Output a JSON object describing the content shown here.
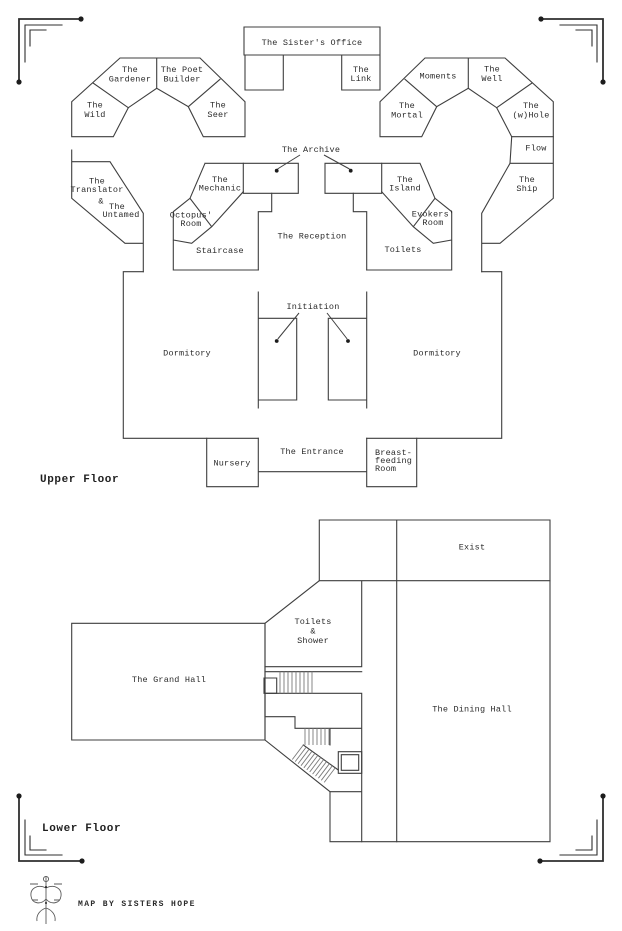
{
  "colors": {
    "background": "#ffffff",
    "line": "#3f3f3f",
    "text": "#2b2b2b"
  },
  "upper_floor": {
    "label": "Upper Floor",
    "rooms": {
      "sisters_office": "The Sister's Office",
      "link": [
        "The",
        "Link"
      ],
      "gardener": [
        "The",
        "Gardener"
      ],
      "poet_builder": [
        "The Poet",
        "Builder"
      ],
      "wild": [
        "The",
        "Wild"
      ],
      "seer": [
        "The",
        "Seer"
      ],
      "moments": "Moments",
      "well": [
        "The",
        "Well"
      ],
      "mortal": [
        "The",
        "Mortal"
      ],
      "whole": [
        "The",
        "(w)Hole"
      ],
      "flow": "Flow",
      "ship": [
        "The",
        "Ship"
      ],
      "translator_untamed": [
        "The",
        "Translator",
        "&",
        "The",
        "Untamed"
      ],
      "archive": "The Archive",
      "mechanic": [
        "The",
        "Mechanic"
      ],
      "octopus_room": [
        "Octopus'",
        "Room"
      ],
      "island": [
        "The",
        "Island"
      ],
      "evokers_room": [
        "Evokers'",
        "Room"
      ],
      "staircase": "Staircase",
      "reception": "The Reception",
      "toilets": "Toilets",
      "initiation": "Initiation",
      "dormitory_left": "Dormitory",
      "dormitory_right": "Dormitory",
      "nursery": "Nursery",
      "entrance": "The Entrance",
      "breastfeeding_room": [
        "Breast-",
        "feeding",
        "Room"
      ]
    }
  },
  "lower_floor": {
    "label": "Lower Floor",
    "rooms": {
      "exist": "Exist",
      "toilets_shower": [
        "Toilets",
        "&",
        "Shower"
      ],
      "grand_hall": "The Grand Hall",
      "dining_hall": "The Dining Hall"
    }
  },
  "credit": "MAP BY SISTERS HOPE"
}
